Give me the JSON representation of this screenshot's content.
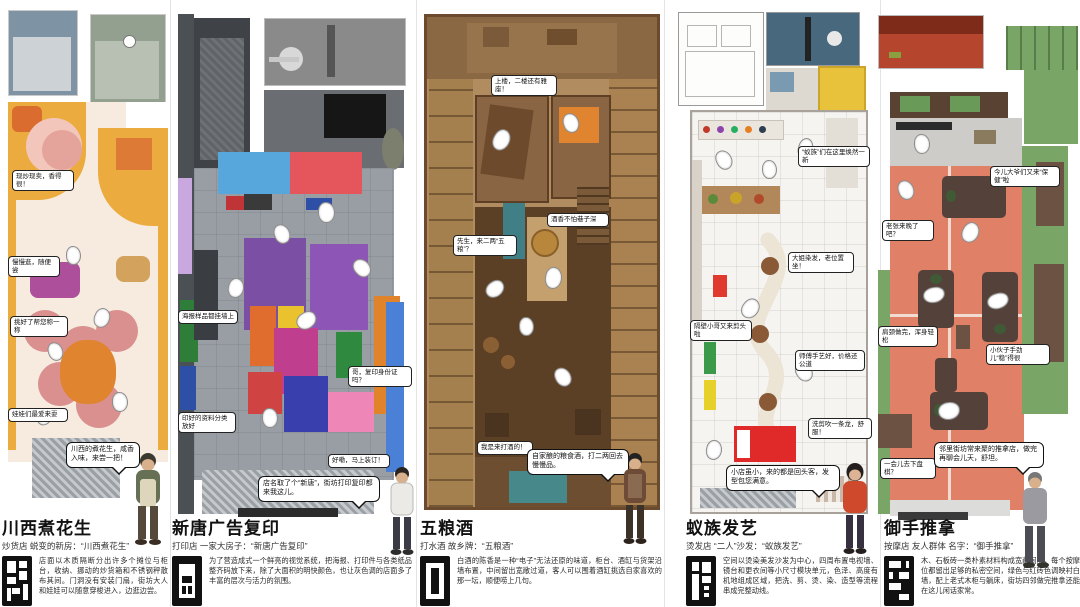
{
  "poster_title": "五间小店改造平面图集",
  "palette": {
    "p1_yellow": "#ecab3e",
    "p1_orange": "#dd7a35",
    "p1_pink": "#f2c6ba",
    "p2_blue": "#57a7dd",
    "p2_red": "#e4555c",
    "p2_purple": "#7b4fa3",
    "p3_wood": "#b08c60",
    "p3_teal": "#47888a",
    "p4_red": "#e02a2a",
    "p4_yellow": "#e8c23a",
    "p5_green": "#79a566",
    "p5_salmon": "#e08066",
    "seal_black": "#111111"
  },
  "seals": [
    "seal-chuanxi-icon",
    "seal-xintang-icon",
    "seal-wuliang-icon",
    "seal-yizu-icon",
    "seal-yushou-icon"
  ],
  "panels": [
    {
      "title": "川西煮花生",
      "subtitle": "炒货店 蜕变的新房：“川西煮花生”",
      "callouts": [
        "现炒现卖，香得很！",
        "慢慢逛，随便尝",
        "挑好了帮您称一称",
        "娃娃们最爱来耍"
      ],
      "bubble": "川西的煮花生，咸香入味，来尝一把！",
      "paragraph": "店面以木质隔断分出许多个摊位与柜台，收纳、挪动的炒货箱和不锈钢秤散布其间。门洞没有安装门扇，街坊大人和娃娃可以随意穿梭进入，边逛边尝。"
    },
    {
      "title": "新唐广告复印",
      "subtitle": "打印店 一家大房子：“新唐广告复印”",
      "callouts": [
        "海报样品都挂墙上",
        "印好的资料分类放好",
        "哥，复印身份证吗？",
        "好嘞，马上装订！"
      ],
      "bubble": "店名取了个“新唐”，街坊打印复印都来我这儿。",
      "paragraph": "为了营造成式一个鲜亮的视觉系统，把海报、打印件与各类纸品整齐码放下来，除了大面积的明快颜色，也让灰色调的店面多了丰富的层次与活力的氛围。"
    },
    {
      "title": "五粮酒",
      "subtitle": "打水酒 故乡牌：“五粮酒”",
      "callouts": [
        "上楼，二楼还有雅座！",
        "先生，来二两“五粮”？",
        "酒香不怕巷子深",
        "我是来打酒的！"
      ],
      "bubble": "自家酿的粮食酒，打二两回去慢慢品。",
      "paragraph": "白酒的陈香是一种“电子”无法还原的味道，柜台、酒缸与货架沿墙布置，中间留出宽敞过道，客人可以围着酒缸挑选自家喜欢的那一坛，顺便唠上几句。"
    },
    {
      "title": "蚁族发艺",
      "subtitle": "烫发店 “二人”沙发：“蚁族发艺”",
      "callouts": [
        "“蚁族”们在这里焕然一新",
        "大姐染发，老位置坐！",
        "隔壁小哥又来剪头啦",
        "师傅手艺好，价格还公道",
        "洗剪吹一条龙，舒服！"
      ],
      "bubble": "小店虽小，来的都是回头客，发型包您满意。",
      "paragraph": "空间以烫染美发沙发为中心，四周布置电视墙、镜台和更衣间等小尺寸模块单元，色泽、高度有机地组成区域，把洗、剪、烫、染、造型等流程串成完整动线。"
    },
    {
      "title": "御手推拿",
      "subtitle": "按摩店 友人群体 名字：“御手推拿”",
      "callouts": [
        "今儿大爷们又来“保健”啦",
        "老张来晚了吧？",
        "肩颈做完，浑身轻松",
        "小伙子手劲儿“稳”得很",
        "一会儿去下盘棋？"
      ],
      "bubble": "邻里街坊常来聚的推拿店，做完再聊会儿天，舒坦。",
      "paragraph": "木、石板砖一类朴素材料构成宽敞间隔，每个按摩位都留出足够的私密空间，绿色与红砖色调映衬白墙，配上老式木柜与躺床，街坊四邻做完推拿还能在这儿闲话家常。"
    }
  ]
}
